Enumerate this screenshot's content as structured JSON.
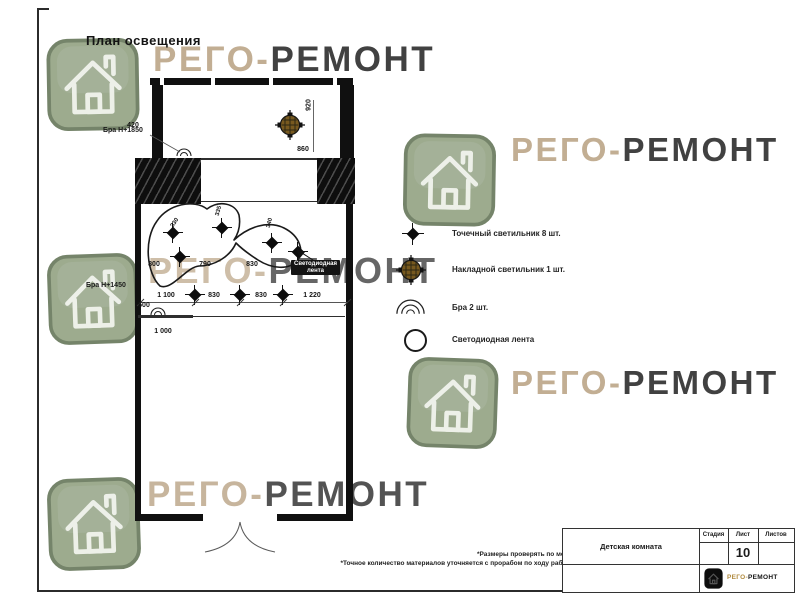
{
  "sheet": {
    "title": "План освещения",
    "note1": "*Размеры проверять по месту",
    "note2": "*Точное количество материалов уточняется с прорабом по ходу работы"
  },
  "brand": {
    "first": "РЕГО-",
    "second": "РЕМОНТ"
  },
  "plan": {
    "labels": {
      "sconce_top": "Бра Н+1850",
      "sconce_mid": "Бра Н+1450",
      "led1": "Светодиодная",
      "led2": "лента"
    },
    "dims": {
      "d420": "420",
      "d920": "920",
      "d860": "860",
      "r1a": "800",
      "r1b": "790",
      "r1c": "830",
      "r2a": "1 100",
      "r2b": "830",
      "r2c": "830",
      "r2d": "1 220",
      "d500": "500",
      "d1000": "1 000",
      "s1": "330",
      "s2": "335",
      "s3": "340"
    }
  },
  "legend": {
    "items": [
      {
        "icon": "spot-light-icon",
        "label": "Точечный светильник 8 шт."
      },
      {
        "icon": "surface-light-icon",
        "label": "Накладной светильник 1 шт."
      },
      {
        "icon": "sconce-icon",
        "label": "Бра 2 шт."
      },
      {
        "icon": "led-strip-icon",
        "label": "Светодиодная лента"
      }
    ]
  },
  "title_block": {
    "room": "Детская комната",
    "stage": "Стадия",
    "sheet": "Лист",
    "sheets": "Листов",
    "number": "10"
  },
  "colors": {
    "tile": "#9dab8e",
    "brand_first": "#c2ae93",
    "brand_second": "#414141",
    "surface_light": "#77591f"
  }
}
